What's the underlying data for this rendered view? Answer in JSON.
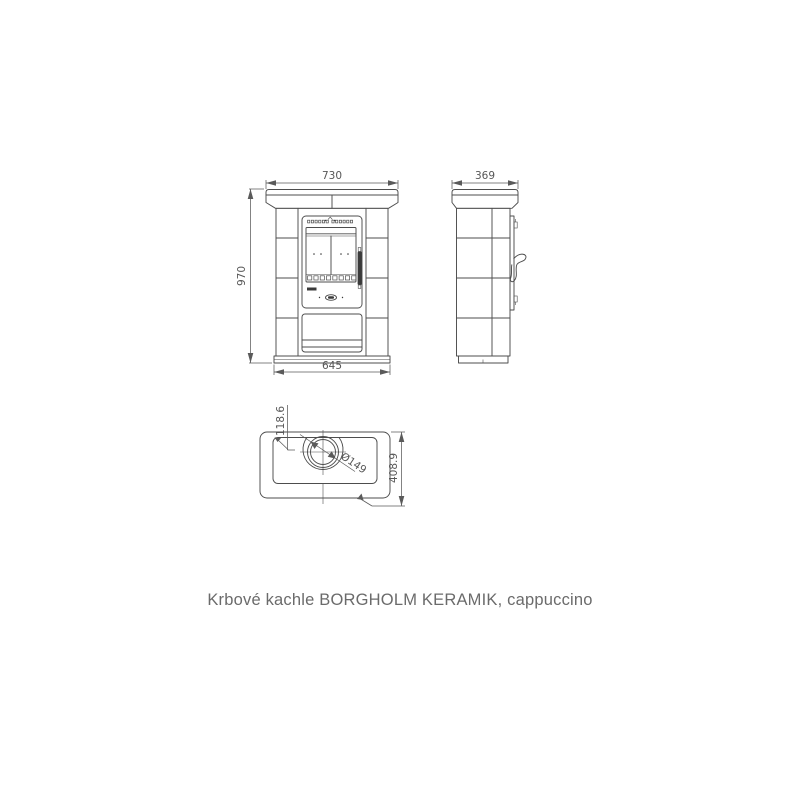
{
  "caption": "Krbové kachle BORGHOLM KERAMIK, cappuccino",
  "drawing": {
    "front_view": {
      "width": "730",
      "height": "970",
      "base_width": "645"
    },
    "side_view": {
      "depth": "369"
    },
    "top_view": {
      "flue_offset": "118.6",
      "flue_diameter": "Ø149",
      "total_depth": "408.9"
    }
  },
  "colors": {
    "line": "#4d4d4d",
    "dim_text": "#575757",
    "caption_text": "#6b6b6b",
    "handle": "#3a3a3a"
  }
}
